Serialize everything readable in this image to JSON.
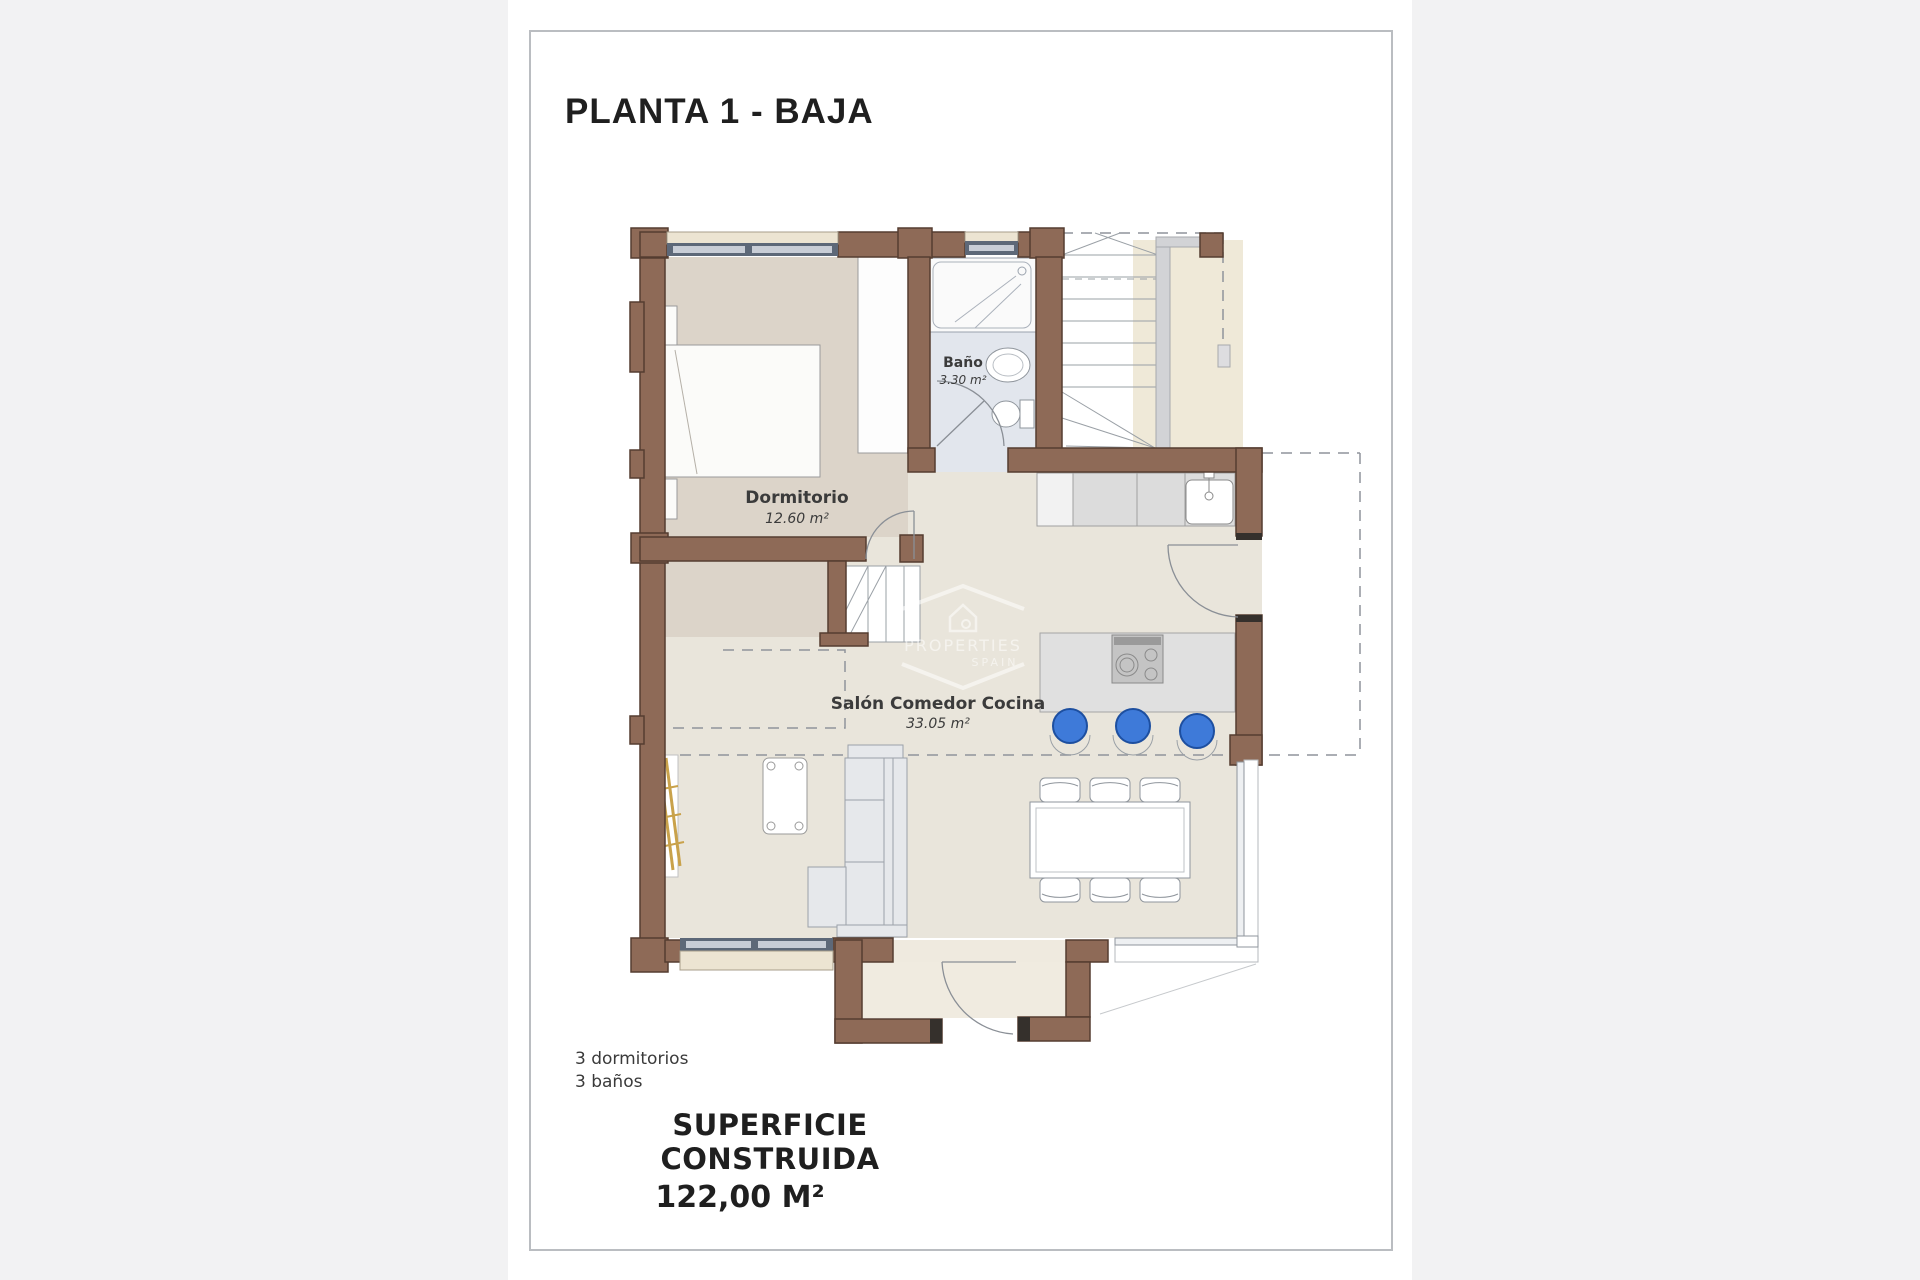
{
  "page": {
    "title": "PLANTA 1 - BAJA",
    "summary": {
      "dormitorios": "3 dormitorios",
      "banos": "3 baños"
    },
    "superficie": {
      "label": "SUPERFICIE CONSTRUIDA",
      "value": "122,00 M²"
    }
  },
  "rooms": {
    "dormitorio": {
      "name": "Dormitorio",
      "area": "12.60 m²"
    },
    "bano": {
      "name": "Baño",
      "area": "3.30 m²"
    },
    "salon": {
      "name": "Salón Comedor Cocina",
      "area": "33.05 m²"
    }
  },
  "watermark": {
    "line1": "PROPERTIES",
    "line2": "SPAIN"
  },
  "colors": {
    "wall": "#8e6a57",
    "wall_outline": "#553d30",
    "floor_bedroom": "#dcd4c9",
    "floor_living": "#e9e5db",
    "floor_bath": "#e2e6ed",
    "terrace_cream": "#efe9d8",
    "stool_blue": "#3e7ad9",
    "glazing": "#5d6878"
  }
}
